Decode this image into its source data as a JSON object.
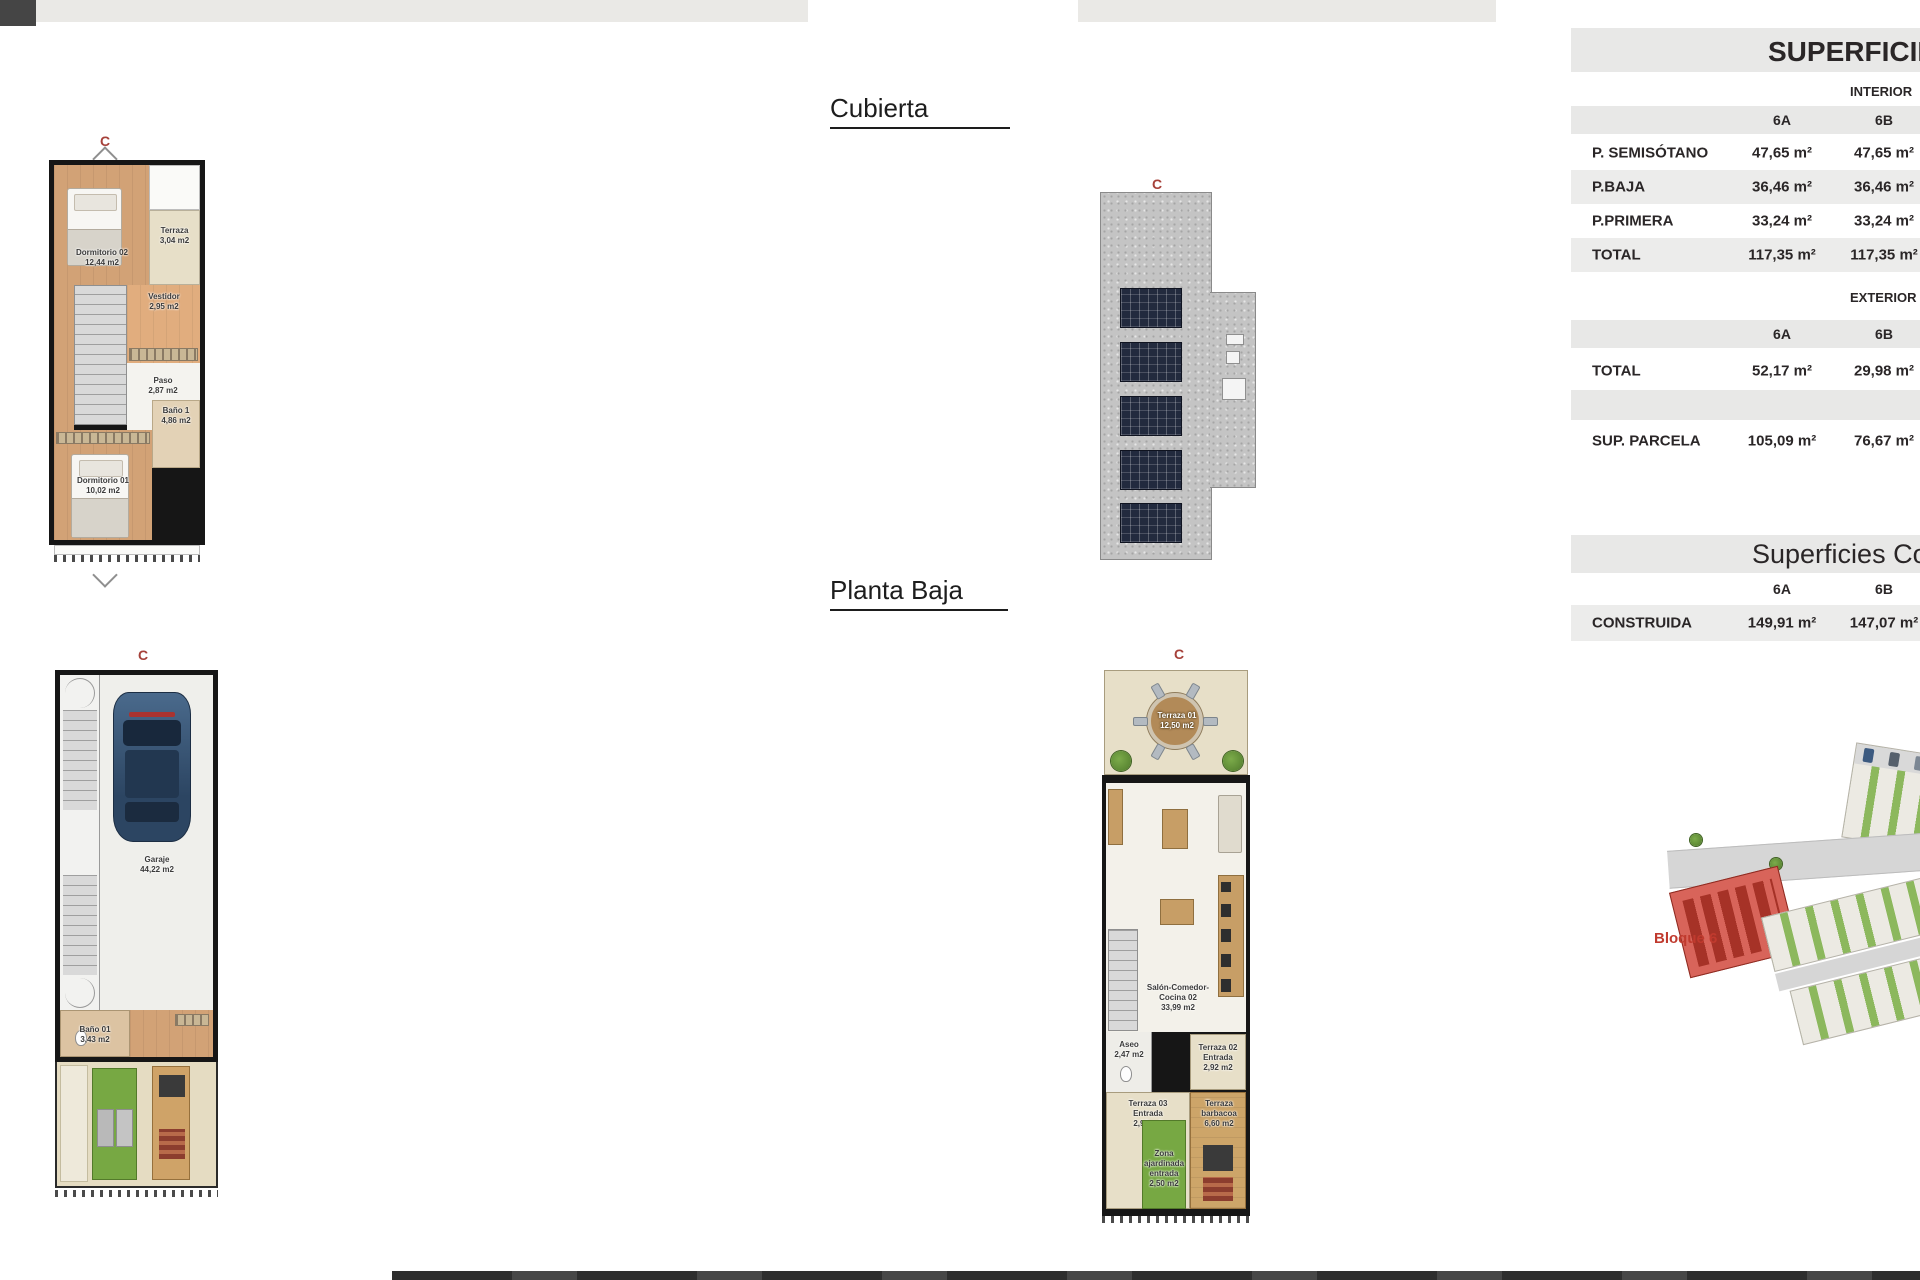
{
  "headings": {
    "cubierta": "Cubierta",
    "planta_baja": "Planta Baja"
  },
  "markers": {
    "letter": "C"
  },
  "tables": {
    "superficies": {
      "title": "SUPERFICIES",
      "sections": [
        {
          "label": "INTERIOR",
          "cols": [
            "6A",
            "6B"
          ],
          "rows": [
            {
              "label": "P. SEMISÓTANO",
              "a": "47,65 m²",
              "b": "47,65 m²"
            },
            {
              "label": "P.BAJA",
              "a": "36,46 m²",
              "b": "36,46 m²"
            },
            {
              "label": "P.PRIMERA",
              "a": "33,24 m²",
              "b": "33,24 m²"
            },
            {
              "label": "TOTAL",
              "a": "117,35 m²",
              "b": "117,35 m²"
            }
          ]
        },
        {
          "label": "EXTERIOR",
          "cols": [
            "6A",
            "6B"
          ],
          "rows": [
            {
              "label": "TOTAL",
              "a": "52,17 m²",
              "b": "29,98 m²"
            },
            {
              "label": "SUP. PARCELA",
              "a": "105,09 m²",
              "b": "76,67 m²"
            }
          ]
        }
      ]
    },
    "construidas": {
      "title": "Superficies Co",
      "cols": [
        "6A",
        "6B"
      ],
      "rows": [
        {
          "label": "CONSTRUIDA",
          "a": "149,91 m²",
          "b": "147,07 m²"
        }
      ]
    }
  },
  "plans": {
    "primera": {
      "rooms": [
        {
          "name": "Terraza",
          "area": "3,04 m2"
        },
        {
          "name": "Dormitorio 02",
          "area": "12,44 m2"
        },
        {
          "name": "Vestidor",
          "area": "2,95 m2"
        },
        {
          "name": "Paso",
          "area": "2,87 m2"
        },
        {
          "name": "Baño 1",
          "area": "4,86 m2"
        },
        {
          "name": "Dormitorio 01",
          "area": "10,02 m2"
        }
      ]
    },
    "semisotano": {
      "rooms": [
        {
          "name": "Garaje",
          "area": "44,22 m2"
        },
        {
          "name": "Baño 01",
          "area": "3,43 m2"
        }
      ]
    },
    "baja": {
      "rooms": [
        {
          "name": "Terraza 01",
          "area": "12,50 m2"
        },
        {
          "name": "Salón-Comedor-Cocina 02",
          "area": "33,99 m2"
        },
        {
          "name": "Aseo",
          "area": "2,47 m2"
        },
        {
          "name": "Terraza 02 Entrada",
          "area": "2,92 m2"
        },
        {
          "name": "Terraza 03 Entrada",
          "area": "2,95 m2"
        },
        {
          "name": "Terraza barbacoa",
          "area": "6,60 m2"
        },
        {
          "name": "Zona ajardinada entrada",
          "area": "2,50 m2"
        }
      ]
    }
  },
  "siteplan": {
    "block_label": "Bloque 6"
  },
  "colors": {
    "accent_red": "#a6413a",
    "bloque_red": "#c03a2e",
    "band_gray": "#e8e8e7",
    "row_gray": "#ececeb",
    "grass_green": "#77a843"
  }
}
